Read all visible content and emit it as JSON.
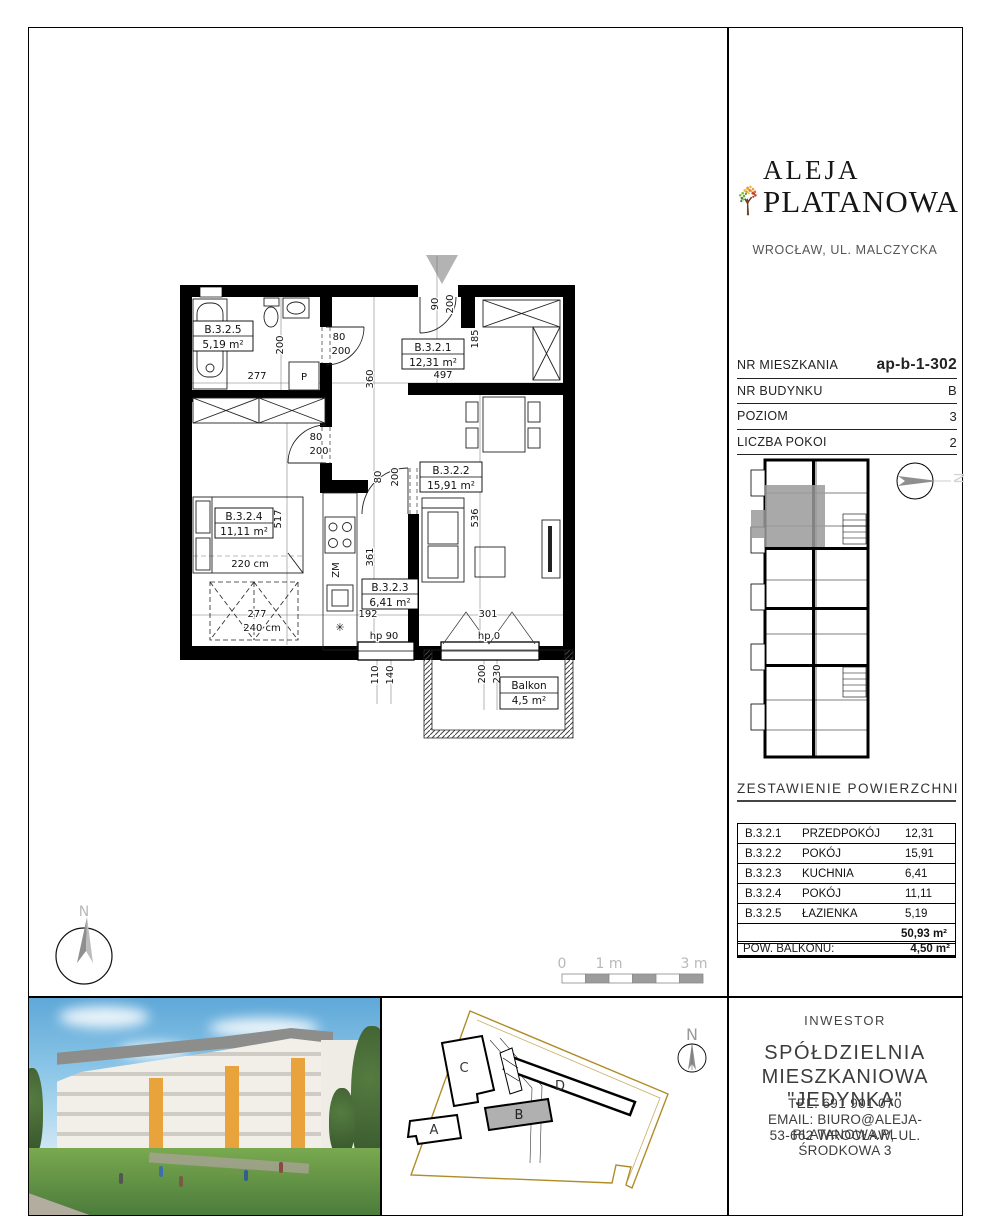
{
  "brand": {
    "name_line1": "ALEJA",
    "name_line2": "PLATANOWA",
    "location": "WROCŁAW, UL. MALCZYCKA"
  },
  "unit_info": {
    "rows": [
      {
        "label": "NR MIESZKANIA",
        "value": "ap-b-1-302"
      },
      {
        "label": "NR BUDYNKU",
        "value": "B"
      },
      {
        "label": "POZIOM",
        "value": "3"
      },
      {
        "label": "LICZBA POKOI",
        "value": "2"
      }
    ]
  },
  "areas": {
    "title": "ZESTAWIENIE POWIERZCHNI",
    "rows": [
      {
        "code": "B.3.2.1",
        "name": "PRZEDPOKÓJ",
        "area": "12,31"
      },
      {
        "code": "B.3.2.2",
        "name": "POKÓJ",
        "area": "15,91"
      },
      {
        "code": "B.3.2.3",
        "name": "KUCHNIA",
        "area": "6,41"
      },
      {
        "code": "B.3.2.4",
        "name": "POKÓJ",
        "area": "11,11"
      },
      {
        "code": "B.3.2.5",
        "name": "ŁAZIENKA",
        "area": "5,19"
      }
    ],
    "total": "50,93 m²",
    "balcony_label": "POW. BALKONU:",
    "balcony_value": "4,50 m²"
  },
  "plan": {
    "rooms": {
      "b321": {
        "code": "B.3.2.1",
        "area": "12,31 m²"
      },
      "b322": {
        "code": "B.3.2.2",
        "area": "15,91 m²"
      },
      "b323": {
        "code": "B.3.2.3",
        "area": "6,41 m²"
      },
      "b324": {
        "code": "B.3.2.4",
        "area": "11,11 m²"
      },
      "b325": {
        "code": "B.3.2.5",
        "area": "5,19 m²"
      },
      "balcony": {
        "code": "Balkon",
        "area": "4,5 m²"
      }
    },
    "dims": {
      "entry_w": "90",
      "entry_h": "200",
      "hall_width": "497",
      "wardrobe_depth": "185",
      "hall_upper": "360",
      "hall_lower": "361",
      "bath_width": "277",
      "bath_depth": "200",
      "bath_door_w": "80",
      "bath_door_h": "200",
      "bed_door_w": "80",
      "bed_door_h": "200",
      "living_door_w": "80",
      "living_door_h": "200",
      "bed_room_h": "517",
      "bed_w": "220 cm",
      "bed_room_w": "277",
      "wardrobe_w": "240 cm",
      "living_h": "536",
      "kwin_w": "192",
      "bwin_w": "301",
      "kwin_sill": "hp 90",
      "kwin_d1": "110",
      "kwin_d2": "140",
      "bwin_sill": "hp 0",
      "bwin_d1": "200",
      "bwin_d2": "230",
      "sink": "ZM",
      "washer": "P"
    }
  },
  "scalebar": {
    "zero": "0",
    "one": "1 m",
    "three": "3 m"
  },
  "main_compass": {
    "n": "N"
  },
  "mini_plan": {
    "compass_n": "N"
  },
  "site_plan": {
    "labels": {
      "a": "A",
      "b": "B",
      "c": "C",
      "d": "D"
    },
    "compass_n": "N"
  },
  "investor": {
    "heading": "INWESTOR",
    "name_line1": "SPÓŁDZIELNIA",
    "name_line2": "MIESZKANIOWA \"JEDYNKA\"",
    "tel": "TEL: 691 901 070",
    "email": "EMAIL: BIURO@ALEJA-PLATANOWA.PL",
    "address": "53-662 WROCŁAW, UL. ŚRODKOWA 3"
  }
}
